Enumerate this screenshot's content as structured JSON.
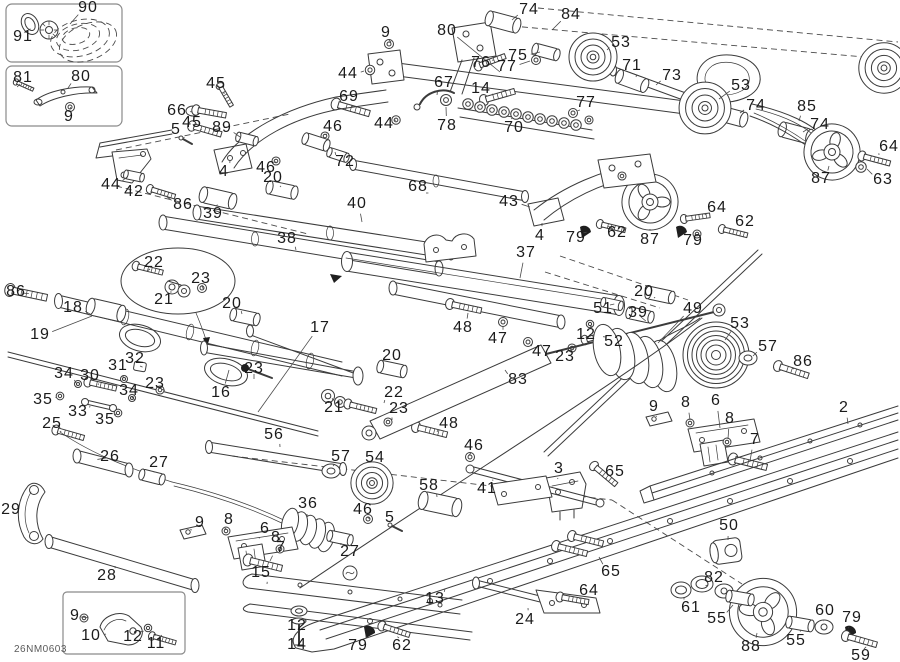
{
  "diagram": {
    "code": "26NM0603",
    "labels": [
      {
        "n": "90",
        "x": 88,
        "y": 8,
        "lx": 70,
        "ly": 24
      },
      {
        "n": "91",
        "x": 23,
        "y": 37,
        "lx": 28,
        "ly": 30
      },
      {
        "n": "81",
        "x": 23,
        "y": 78,
        "lx": 20,
        "ly": 84
      },
      {
        "n": "80",
        "x": 81,
        "y": 77,
        "lx": 68,
        "ly": 88
      },
      {
        "n": "9",
        "x": 69,
        "y": 117,
        "lx": 70,
        "ly": 109
      },
      {
        "n": "45",
        "x": 216,
        "y": 84,
        "lx": 224,
        "ly": 94
      },
      {
        "n": "66",
        "x": 177,
        "y": 111,
        "lx": 192,
        "ly": 112
      },
      {
        "n": "45",
        "x": 192,
        "y": 123,
        "lx": 200,
        "ly": 130
      },
      {
        "n": "5",
        "x": 176,
        "y": 130,
        "lx": 183,
        "ly": 138
      },
      {
        "n": "89",
        "x": 222,
        "y": 128,
        "lx": 240,
        "ly": 137
      },
      {
        "n": "4",
        "x": 224,
        "y": 172,
        "lx": 230,
        "ly": 160
      },
      {
        "n": "46",
        "x": 333,
        "y": 127,
        "lx": 327,
        "ly": 134
      },
      {
        "n": "46",
        "x": 266,
        "y": 168,
        "lx": 274,
        "ly": 162
      },
      {
        "n": "20",
        "x": 273,
        "y": 178,
        "lx": 280,
        "ly": 187
      },
      {
        "n": "44",
        "x": 111,
        "y": 185,
        "lx": 127,
        "ly": 177
      },
      {
        "n": "42",
        "x": 134,
        "y": 192,
        "lx": 131,
        "ly": 183
      },
      {
        "n": "86",
        "x": 183,
        "y": 205,
        "lx": 166,
        "ly": 196
      },
      {
        "n": "39",
        "x": 213,
        "y": 214,
        "lx": 216,
        "ly": 206
      },
      {
        "n": "38",
        "x": 287,
        "y": 239,
        "lx": 296,
        "ly": 250
      },
      {
        "n": "40",
        "x": 357,
        "y": 204,
        "lx": 362,
        "ly": 222
      },
      {
        "n": "68",
        "x": 418,
        "y": 187,
        "lx": 426,
        "ly": 193
      },
      {
        "n": "72",
        "x": 345,
        "y": 162,
        "lx": 335,
        "ly": 152
      },
      {
        "n": "69",
        "x": 349,
        "y": 97,
        "lx": 352,
        "ly": 106
      },
      {
        "n": "44",
        "x": 348,
        "y": 74,
        "lx": 364,
        "ly": 71
      },
      {
        "n": "9",
        "x": 386,
        "y": 33,
        "lx": 389,
        "ly": 40
      },
      {
        "n": "80",
        "x": 447,
        "y": 31,
        "lx": 500,
        "ly": 72
      },
      {
        "n": "74",
        "x": 529,
        "y": 10,
        "lx": 512,
        "ly": 20
      },
      {
        "n": "84",
        "x": 571,
        "y": 15,
        "lx": 552,
        "ly": 30
      },
      {
        "n": "75",
        "x": 518,
        "y": 56,
        "lx": 540,
        "ly": 52
      },
      {
        "n": "76",
        "x": 481,
        "y": 63,
        "lx": 492,
        "ly": 60
      },
      {
        "n": "77",
        "x": 507,
        "y": 67,
        "lx": 530,
        "ly": 61
      },
      {
        "n": "67",
        "x": 444,
        "y": 83,
        "lx": 437,
        "ly": 95
      },
      {
        "n": "14",
        "x": 481,
        "y": 89,
        "lx": 492,
        "ly": 95
      },
      {
        "n": "78",
        "x": 447,
        "y": 126,
        "lx": 446,
        "ly": 107
      },
      {
        "n": "70",
        "x": 514,
        "y": 128,
        "lx": 512,
        "ly": 119
      },
      {
        "n": "77",
        "x": 586,
        "y": 103,
        "lx": 580,
        "ly": 110
      },
      {
        "n": "44",
        "x": 384,
        "y": 124,
        "lx": 394,
        "ly": 120
      },
      {
        "n": "43",
        "x": 509,
        "y": 202,
        "lx": 530,
        "ly": 207
      },
      {
        "n": "53",
        "x": 621,
        "y": 43,
        "lx": 607,
        "ly": 50
      },
      {
        "n": "71",
        "x": 632,
        "y": 66,
        "lx": 636,
        "ly": 77
      },
      {
        "n": "73",
        "x": 672,
        "y": 76,
        "lx": 656,
        "ly": 85
      },
      {
        "n": "53",
        "x": 741,
        "y": 86,
        "lx": 719,
        "ly": 99
      },
      {
        "n": "74",
        "x": 756,
        "y": 106,
        "lx": 740,
        "ly": 113
      },
      {
        "n": "85",
        "x": 807,
        "y": 107,
        "lx": 799,
        "ly": 121
      },
      {
        "n": "74",
        "x": 820,
        "y": 125,
        "lx": 803,
        "ly": 132
      },
      {
        "n": "64",
        "x": 889,
        "y": 147,
        "lx": 879,
        "ly": 155
      },
      {
        "n": "63",
        "x": 883,
        "y": 180,
        "lx": 867,
        "ly": 169
      },
      {
        "n": "87",
        "x": 821,
        "y": 179,
        "lx": 829,
        "ly": 166
      },
      {
        "n": "64",
        "x": 717,
        "y": 208,
        "lx": 705,
        "ly": 215
      },
      {
        "n": "62",
        "x": 745,
        "y": 222,
        "lx": 740,
        "ly": 231
      },
      {
        "n": "79",
        "x": 693,
        "y": 241,
        "lx": 686,
        "ly": 234
      },
      {
        "n": "87",
        "x": 650,
        "y": 240,
        "lx": 650,
        "ly": 229
      },
      {
        "n": "62",
        "x": 617,
        "y": 233,
        "lx": 613,
        "ly": 229
      },
      {
        "n": "79",
        "x": 576,
        "y": 238,
        "lx": 583,
        "ly": 233
      },
      {
        "n": "4",
        "x": 540,
        "y": 236,
        "lx": 542,
        "ly": 223
      },
      {
        "n": "37",
        "x": 526,
        "y": 253,
        "lx": 520,
        "ly": 278
      },
      {
        "n": "86",
        "x": 16,
        "y": 292,
        "lx": 22,
        "ly": 293
      },
      {
        "n": "18",
        "x": 73,
        "y": 308,
        "lx": 90,
        "ly": 314
      },
      {
        "n": "19",
        "x": 40,
        "y": 335,
        "lx": 92,
        "ly": 316
      },
      {
        "n": "22",
        "x": 154,
        "y": 263,
        "lx": 150,
        "ly": 269
      },
      {
        "n": "23",
        "x": 201,
        "y": 279,
        "lx": 202,
        "ly": 285
      },
      {
        "n": "21",
        "x": 164,
        "y": 300,
        "lx": 170,
        "ly": 292
      },
      {
        "n": "20",
        "x": 232,
        "y": 304,
        "lx": 242,
        "ly": 314
      },
      {
        "n": "17",
        "x": 320,
        "y": 328,
        "lx": 258,
        "ly": 412
      },
      {
        "n": "48",
        "x": 463,
        "y": 328,
        "lx": 468,
        "ly": 313
      },
      {
        "n": "47",
        "x": 498,
        "y": 339,
        "lx": 503,
        "ly": 327
      },
      {
        "n": "12",
        "x": 586,
        "y": 335,
        "lx": 590,
        "ly": 327
      },
      {
        "n": "51",
        "x": 603,
        "y": 309,
        "lx": 610,
        "ly": 305
      },
      {
        "n": "20",
        "x": 644,
        "y": 292,
        "lx": 654,
        "ly": 298
      },
      {
        "n": "39",
        "x": 638,
        "y": 313,
        "lx": 641,
        "ly": 317
      },
      {
        "n": "52",
        "x": 614,
        "y": 342,
        "lx": 606,
        "ly": 337
      },
      {
        "n": "47",
        "x": 542,
        "y": 352,
        "lx": 531,
        "ly": 344
      },
      {
        "n": "23",
        "x": 565,
        "y": 357,
        "lx": 571,
        "ly": 350
      },
      {
        "n": "49",
        "x": 693,
        "y": 309,
        "lx": 658,
        "ly": 343
      },
      {
        "n": "53",
        "x": 740,
        "y": 324,
        "lx": 725,
        "ly": 340
      },
      {
        "n": "57",
        "x": 768,
        "y": 347,
        "lx": 753,
        "ly": 356
      },
      {
        "n": "86",
        "x": 803,
        "y": 362,
        "lx": 794,
        "ly": 369
      },
      {
        "n": "32",
        "x": 135,
        "y": 359,
        "lx": 140,
        "ly": 366
      },
      {
        "n": "31",
        "x": 118,
        "y": 366,
        "lx": 123,
        "ly": 377
      },
      {
        "n": "34",
        "x": 64,
        "y": 374,
        "lx": 76,
        "ly": 383
      },
      {
        "n": "30",
        "x": 90,
        "y": 376,
        "lx": 98,
        "ly": 385
      },
      {
        "n": "23",
        "x": 155,
        "y": 384,
        "lx": 161,
        "ly": 389
      },
      {
        "n": "34",
        "x": 129,
        "y": 391,
        "lx": 132,
        "ly": 397
      },
      {
        "n": "35",
        "x": 43,
        "y": 400,
        "lx": 56,
        "ly": 397
      },
      {
        "n": "33",
        "x": 78,
        "y": 412,
        "lx": 90,
        "ly": 406
      },
      {
        "n": "35",
        "x": 105,
        "y": 420,
        "lx": 115,
        "ly": 414
      },
      {
        "n": "25",
        "x": 52,
        "y": 424,
        "lx": 60,
        "ly": 432
      },
      {
        "n": "16",
        "x": 221,
        "y": 393,
        "lx": 229,
        "ly": 370
      },
      {
        "n": "23",
        "x": 254,
        "y": 369,
        "lx": 254,
        "ly": 374
      },
      {
        "n": "20",
        "x": 392,
        "y": 356,
        "lx": 392,
        "ly": 366
      },
      {
        "n": "22",
        "x": 394,
        "y": 393,
        "lx": 384,
        "ly": 403
      },
      {
        "n": "21",
        "x": 334,
        "y": 408,
        "lx": 333,
        "ly": 401
      },
      {
        "n": "23",
        "x": 399,
        "y": 409,
        "lx": 392,
        "ly": 420
      },
      {
        "n": "83",
        "x": 518,
        "y": 380,
        "lx": 505,
        "ly": 370
      },
      {
        "n": "48",
        "x": 449,
        "y": 424,
        "lx": 437,
        "ly": 432
      },
      {
        "n": "56",
        "x": 274,
        "y": 435,
        "lx": 280,
        "ly": 447
      },
      {
        "n": "2",
        "x": 844,
        "y": 408,
        "lx": 848,
        "ly": 424
      },
      {
        "n": "9",
        "x": 654,
        "y": 407,
        "lx": 656,
        "ly": 416
      },
      {
        "n": "8",
        "x": 686,
        "y": 403,
        "lx": 690,
        "ly": 420
      },
      {
        "n": "6",
        "x": 716,
        "y": 401,
        "lx": 720,
        "ly": 428
      },
      {
        "n": "8",
        "x": 730,
        "y": 419,
        "lx": 728,
        "ly": 439
      },
      {
        "n": "7",
        "x": 755,
        "y": 440,
        "lx": 750,
        "ly": 461
      },
      {
        "n": "26",
        "x": 110,
        "y": 457,
        "lx": 106,
        "ly": 458
      },
      {
        "n": "27",
        "x": 159,
        "y": 463,
        "lx": 155,
        "ly": 472
      },
      {
        "n": "29",
        "x": 11,
        "y": 510,
        "lx": 24,
        "ly": 510
      },
      {
        "n": "9",
        "x": 200,
        "y": 523,
        "lx": 192,
        "ly": 530
      },
      {
        "n": "8",
        "x": 229,
        "y": 520,
        "lx": 226,
        "ly": 528
      },
      {
        "n": "6",
        "x": 265,
        "y": 529,
        "lx": 260,
        "ly": 538
      },
      {
        "n": "8",
        "x": 276,
        "y": 538,
        "lx": 280,
        "ly": 547
      },
      {
        "n": "7",
        "x": 281,
        "y": 548,
        "lx": 270,
        "ly": 561
      },
      {
        "n": "28",
        "x": 107,
        "y": 576,
        "lx": 115,
        "ly": 566
      },
      {
        "n": "15",
        "x": 261,
        "y": 573,
        "lx": 267,
        "ly": 584
      },
      {
        "n": "36",
        "x": 308,
        "y": 504,
        "lx": 307,
        "ly": 517
      },
      {
        "n": "46",
        "x": 363,
        "y": 510,
        "lx": 367,
        "ly": 517
      },
      {
        "n": "5",
        "x": 390,
        "y": 518,
        "lx": 393,
        "ly": 525
      },
      {
        "n": "27",
        "x": 350,
        "y": 552,
        "lx": 341,
        "ly": 543
      },
      {
        "n": "57",
        "x": 341,
        "y": 457,
        "lx": 334,
        "ly": 466
      },
      {
        "n": "54",
        "x": 375,
        "y": 458,
        "lx": 374,
        "ly": 467
      },
      {
        "n": "46",
        "x": 474,
        "y": 446,
        "lx": 471,
        "ly": 453
      },
      {
        "n": "3",
        "x": 559,
        "y": 469,
        "lx": 558,
        "ly": 478
      },
      {
        "n": "58",
        "x": 429,
        "y": 486,
        "lx": 437,
        "ly": 497
      },
      {
        "n": "41",
        "x": 487,
        "y": 489,
        "lx": 492,
        "ly": 480
      },
      {
        "n": "13",
        "x": 435,
        "y": 599,
        "lx": 445,
        "ly": 589
      },
      {
        "n": "64",
        "x": 589,
        "y": 591,
        "lx": 580,
        "ly": 599
      },
      {
        "n": "24",
        "x": 525,
        "y": 620,
        "lx": 528,
        "ly": 608
      },
      {
        "n": "79",
        "x": 358,
        "y": 646,
        "lx": 366,
        "ly": 636
      },
      {
        "n": "62",
        "x": 402,
        "y": 646,
        "lx": 399,
        "ly": 638
      },
      {
        "n": "12",
        "x": 297,
        "y": 626,
        "lx": 299,
        "ly": 616
      },
      {
        "n": "14",
        "x": 297,
        "y": 645,
        "lx": 299,
        "ly": 635
      },
      {
        "n": "65",
        "x": 615,
        "y": 472,
        "lx": 607,
        "ly": 479
      },
      {
        "n": "65",
        "x": 611,
        "y": 572,
        "lx": 599,
        "ly": 557
      },
      {
        "n": "50",
        "x": 729,
        "y": 526,
        "lx": 728,
        "ly": 540
      },
      {
        "n": "82",
        "x": 714,
        "y": 578,
        "lx": 708,
        "ly": 585
      },
      {
        "n": "61",
        "x": 691,
        "y": 608,
        "lx": 684,
        "ly": 597
      },
      {
        "n": "55",
        "x": 717,
        "y": 619,
        "lx": 733,
        "ly": 605
      },
      {
        "n": "88",
        "x": 751,
        "y": 647,
        "lx": 757,
        "ly": 633
      },
      {
        "n": "55",
        "x": 796,
        "y": 641,
        "lx": 800,
        "ly": 630
      },
      {
        "n": "60",
        "x": 825,
        "y": 611,
        "lx": 824,
        "ly": 621
      },
      {
        "n": "79",
        "x": 852,
        "y": 618,
        "lx": 849,
        "ly": 628
      },
      {
        "n": "59",
        "x": 861,
        "y": 656,
        "lx": 864,
        "ly": 649
      },
      {
        "n": "9",
        "x": 75,
        "y": 616,
        "lx": 81,
        "ly": 617
      },
      {
        "n": "10",
        "x": 91,
        "y": 636,
        "lx": 106,
        "ly": 634
      },
      {
        "n": "12",
        "x": 133,
        "y": 637,
        "lx": 140,
        "ly": 632
      },
      {
        "n": "11",
        "x": 156,
        "y": 644,
        "lx": 158,
        "ly": 640
      }
    ]
  }
}
